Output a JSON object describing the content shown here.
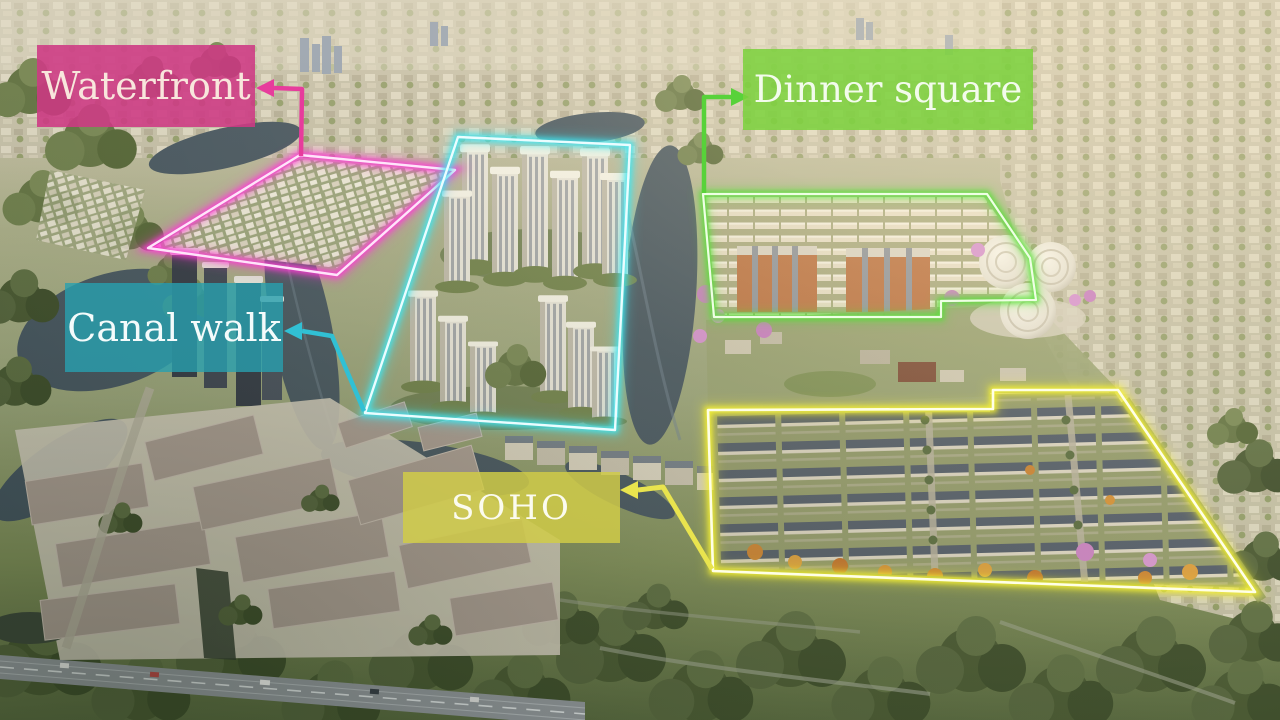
{
  "zones": [
    {
      "id": "waterfront",
      "label": "Waterfront",
      "box_color": "rgba(206,57,132,0.88)",
      "text_color": "#f8e6dc",
      "line_color": "#ff3bd6",
      "core_color": "#ffe4fa",
      "connector_color": "#e73c9c"
    },
    {
      "id": "canal-walk",
      "label": "Canal walk",
      "box_color": "rgba(40,160,175,0.80)",
      "text_color": "#f4fbfb",
      "line_color": "#3fe6f2",
      "core_color": "#eafdff",
      "connector_color": "#31c0d4"
    },
    {
      "id": "dinner-square",
      "label": "Dinner square",
      "box_color": "rgba(124,210,60,0.86)",
      "text_color": "#f3fbec",
      "line_color": "#57e135",
      "core_color": "#eeffe4",
      "connector_color": "#58d23a"
    },
    {
      "id": "soho",
      "label": "SOHO",
      "box_color": "rgba(209,204,72,0.84)",
      "text_color": "#fbfbef",
      "line_color": "#f6f233",
      "core_color": "#ffffe6",
      "connector_color": "#e9e44e"
    }
  ]
}
